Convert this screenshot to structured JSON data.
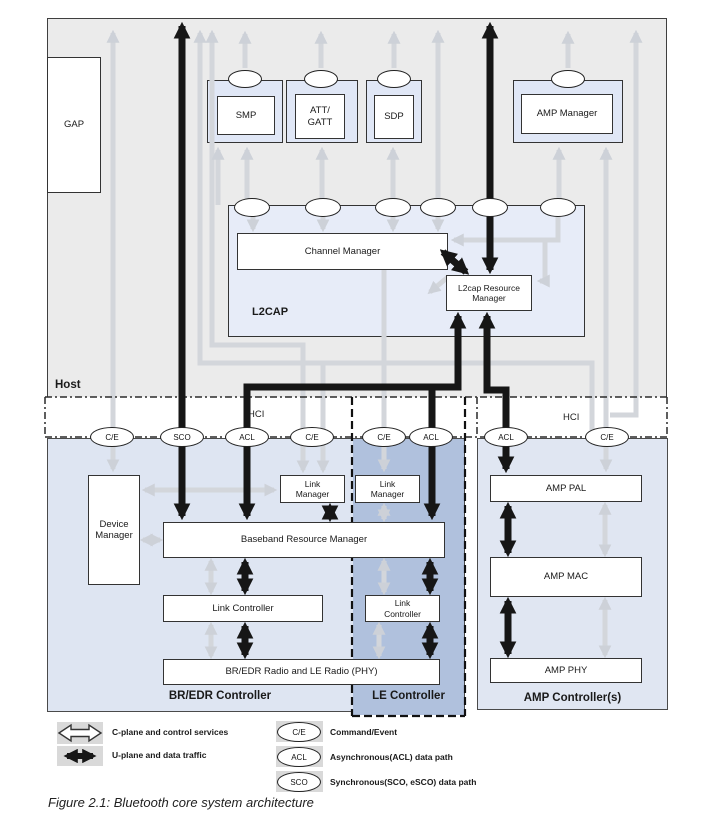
{
  "host": {
    "label": "Host",
    "gap": "GAP",
    "boxes": {
      "smp": "SMP",
      "att_gatt": "ATT/\nGATT",
      "sdp": "SDP",
      "amp_manager": "AMP Manager"
    }
  },
  "l2cap": {
    "label": "L2CAP",
    "channel_manager": "Channel Manager",
    "resource_manager": "L2cap Resource Manager"
  },
  "hci": {
    "label_left": "HCI",
    "label_right": "HCI",
    "ovals": [
      "C/E",
      "SCO",
      "ACL",
      "C/E",
      "C/E",
      "ACL",
      "ACL",
      "C/E"
    ]
  },
  "controllers": {
    "bredr": {
      "label": "BR/EDR Controller",
      "device_manager": "Device Manager",
      "link_manager": "Link Manager",
      "baseband": "Baseband Resource Manager",
      "link_controller": "Link Controller",
      "phy": "BR/EDR Radio and LE Radio (PHY)"
    },
    "le": {
      "label": "LE Controller",
      "link_manager": "Link Manager",
      "link_controller": "Link\nController"
    },
    "amp": {
      "label": "AMP Controller(s)",
      "pal": "AMP PAL",
      "mac": "AMP MAC",
      "phy": "AMP PHY"
    }
  },
  "legend": {
    "items": [
      {
        "icon": "outline-double-arrow",
        "label": "C-plane and control services"
      },
      {
        "icon": "black-double-arrow",
        "label": "U-plane and data traffic"
      },
      {
        "icon": "oval",
        "oval": "C/E",
        "label": "Command/Event"
      },
      {
        "icon": "oval",
        "oval": "ACL",
        "label": "Asynchronous(ACL) data path"
      },
      {
        "icon": "oval",
        "oval": "SCO",
        "label": "Synchronous(SCO, eSCO) data path"
      }
    ]
  },
  "caption": "Figure 2.1:  Bluetooth core system architecture",
  "colors": {
    "host_bg": "#ebebeb",
    "controller_bg": "#dee5f2",
    "le_bg": "#b0c1dd",
    "l2cap_bg": "#e7ecf8",
    "c_plane_gray": "#d3d6db",
    "u_plane_black": "#161616"
  }
}
